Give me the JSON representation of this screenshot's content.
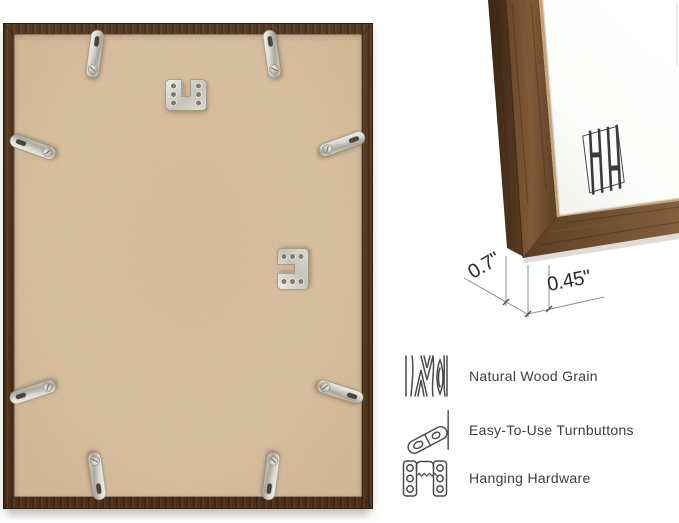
{
  "dimensions": {
    "depth": "0.7\"",
    "face_width": "0.45\""
  },
  "features": [
    {
      "icon": "wood-grain-icon",
      "label": "Natural Wood Grain"
    },
    {
      "icon": "turnbutton-icon",
      "label": "Easy-To-Use Turnbuttons"
    },
    {
      "icon": "hanging-hardware-icon",
      "label": "Hanging Hardware"
    }
  ],
  "hardware": {
    "turnbuttons_visible": 8,
    "sawtooth_hangers_visible": 2
  },
  "colors": {
    "background": "#ffffff",
    "frame_wood_dark": "#4a311d",
    "frame_wood": "#5b3f27",
    "frame_wood_light": "#7a5636",
    "backing_mdf": "#d7bc9a",
    "metal_hardware": "#d6d4cc",
    "label_text": "#3e3e3e",
    "dimension_line": "#8f8f8f"
  }
}
